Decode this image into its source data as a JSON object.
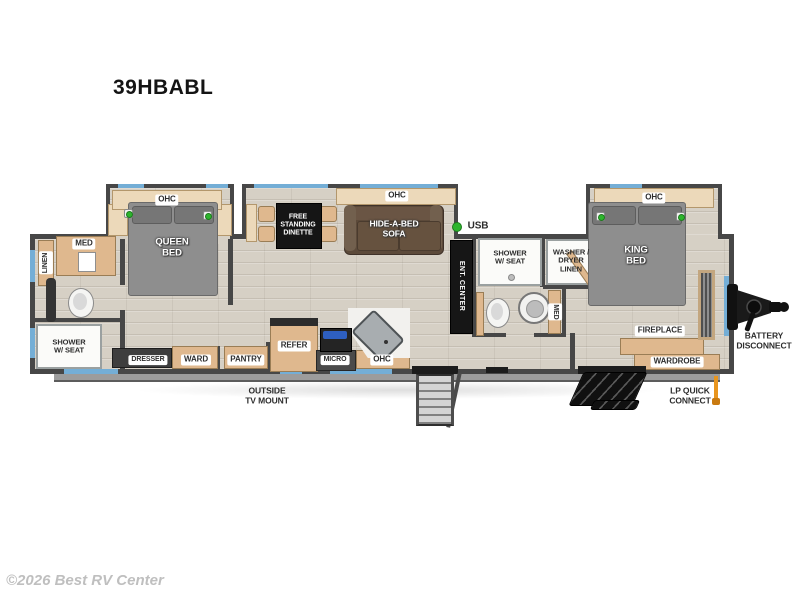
{
  "model": "39HBABL",
  "watermark": "©2026 Best RV Center",
  "labels": {
    "ohc": "OHC",
    "queen_bed": "QUEEN\nBED",
    "king_bed": "KING\nBED",
    "free_standing_dinette": "FREE\nSTANDING\nDINETTE",
    "hide_a_bed_sofa": "HIDE-A-BED\nSOFA",
    "usb": "USB",
    "linen": "LINEN",
    "med": "MED",
    "shower_w_seat": "SHOWER\nW/ SEAT",
    "dresser": "DRESSER",
    "ward": "WARD",
    "pantry": "PANTRY",
    "refer": "REFER",
    "micro": "MICRO",
    "outside_tv_mount": "OUTSIDE\nTV MOUNT",
    "ent_center": "ENT. CENTER",
    "washer_dryer_linen": "WASHER /\nDRYER\nLINEN",
    "fireplace": "FIREPLACE",
    "wardrobe": "WARDROBE",
    "lp_quick_connect": "LP QUICK\nCONNECT",
    "battery_disconnect": "BATTERY\nDISCONNECT"
  },
  "colors": {
    "wall": "#474747",
    "floor": "#d6d0c5",
    "wood": "#dfb88e",
    "window_accent": "#74aed6",
    "bed_gray": "#8e8e8e",
    "sofa_brown": "#5c4a3a",
    "indicator_green": "#2db52d",
    "lp_orange": "#e8951e"
  }
}
